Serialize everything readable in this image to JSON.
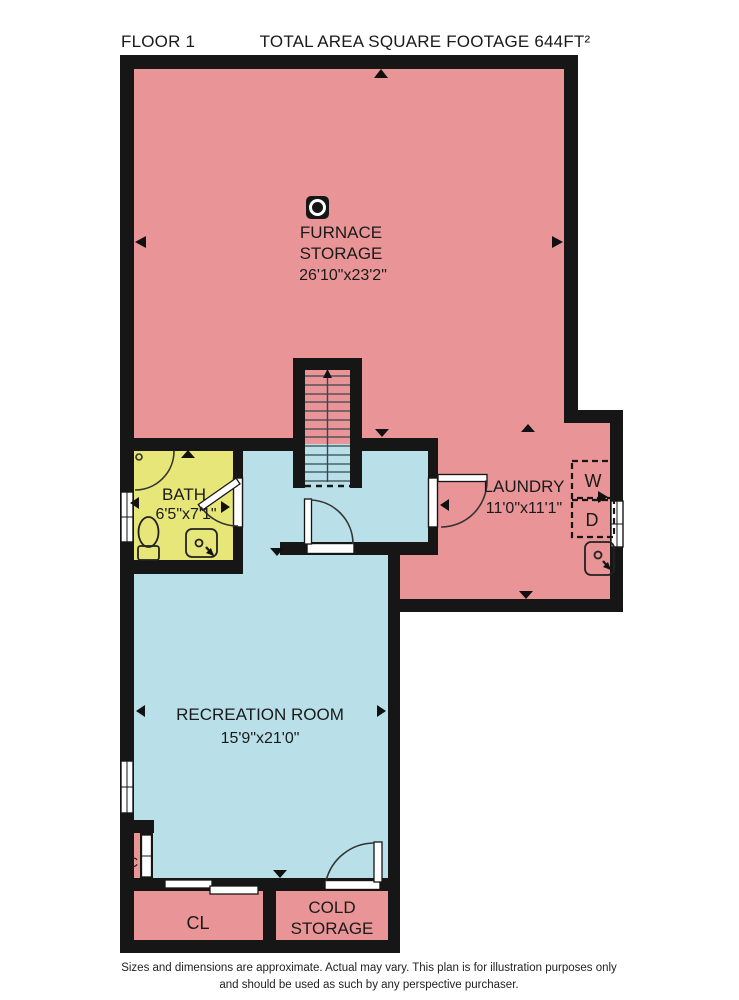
{
  "header": {
    "floor_label": "FLOOR 1",
    "total_area": "TOTAL AREA SQUARE FOOTAGE 644FT²"
  },
  "colors": {
    "room_pink": "#e99496",
    "room_yellow": "#e7e679",
    "room_blue": "#b9e0e9",
    "wall": "#161616",
    "opening": "#ffffff",
    "fixture_fill": "#f0eecf"
  },
  "rooms": {
    "furnace": {
      "label_line1": "FURNACE",
      "label_line2": "STORAGE",
      "dims": "26'10\"x23'2\""
    },
    "bath": {
      "label": "BATH",
      "dims": "6'5\"x7'1\""
    },
    "laundry": {
      "label": "LAUNDRY",
      "dims": "11'0\"x11'1\""
    },
    "recreation": {
      "label": "RECREATION ROOM",
      "dims": "15'9\"x21'0\""
    },
    "closet": {
      "label": "CL"
    },
    "cold_storage": {
      "label_line1": "COLD",
      "label_line2": "STORAGE"
    },
    "small_closet": {
      "label": "C"
    }
  },
  "appliances": {
    "washer": "W",
    "dryer": "D"
  },
  "footer": {
    "line1": "Sizes and dimensions are approximate. Actual may vary. This plan is for illustration purposes only",
    "line2": "and should be used as such by any perspective purchaser."
  }
}
